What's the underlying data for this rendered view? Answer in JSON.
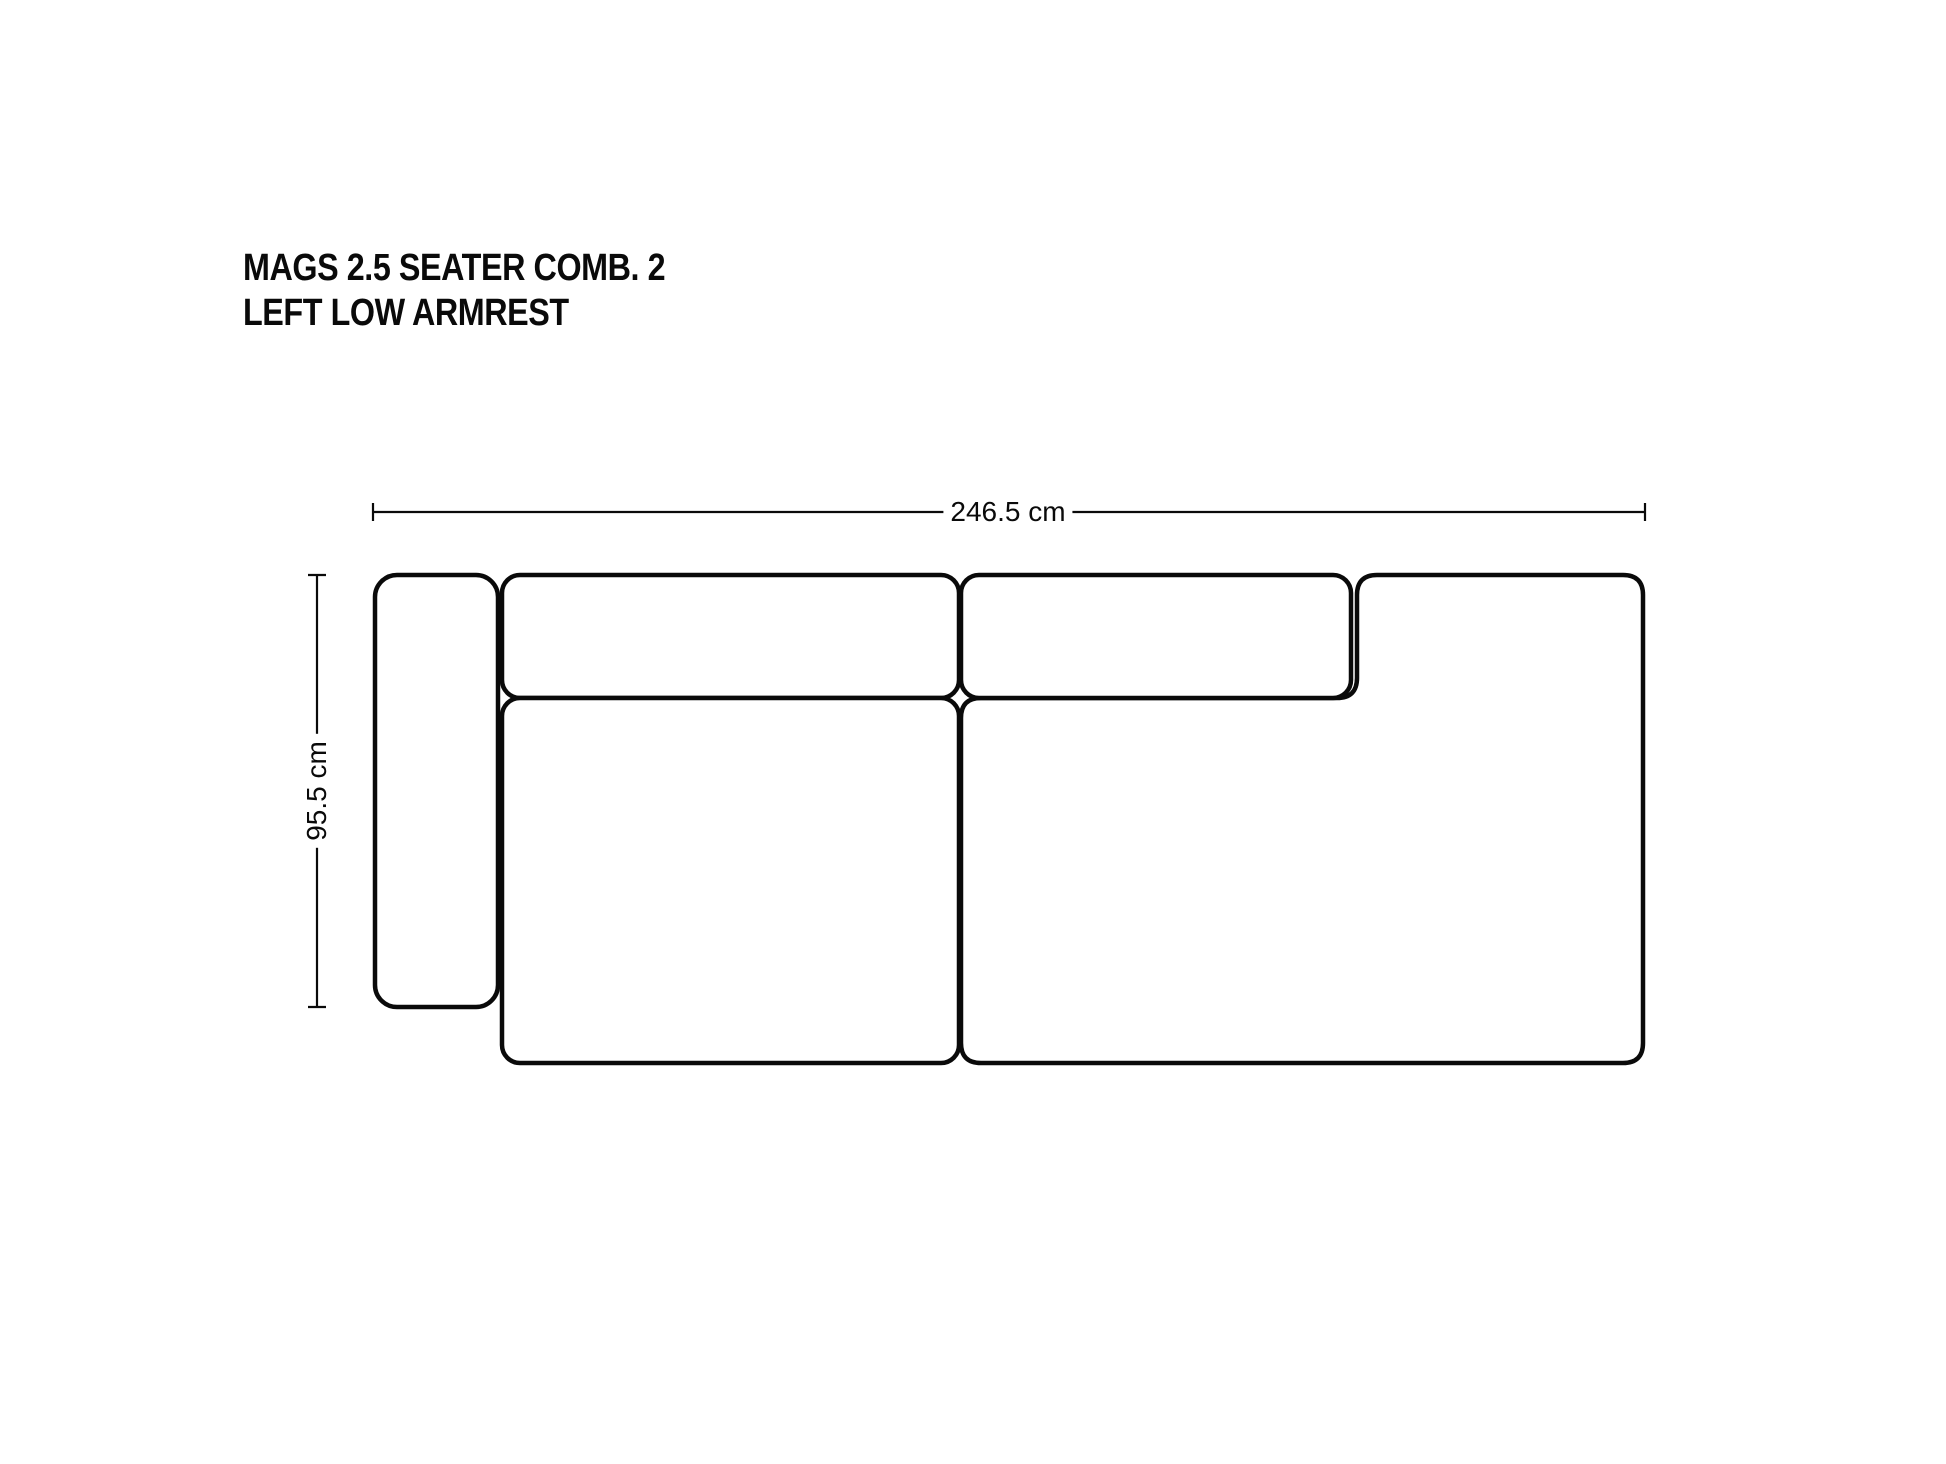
{
  "title": {
    "line1": "MAGS 2.5 SEATER COMB. 2",
    "line2": "LEFT LOW ARMREST"
  },
  "dimensions": {
    "width": {
      "label": "246.5 cm"
    },
    "depth": {
      "label": "95.5 cm"
    }
  },
  "colors": {
    "ink": "#0a0a0a",
    "background": "#ffffff"
  }
}
